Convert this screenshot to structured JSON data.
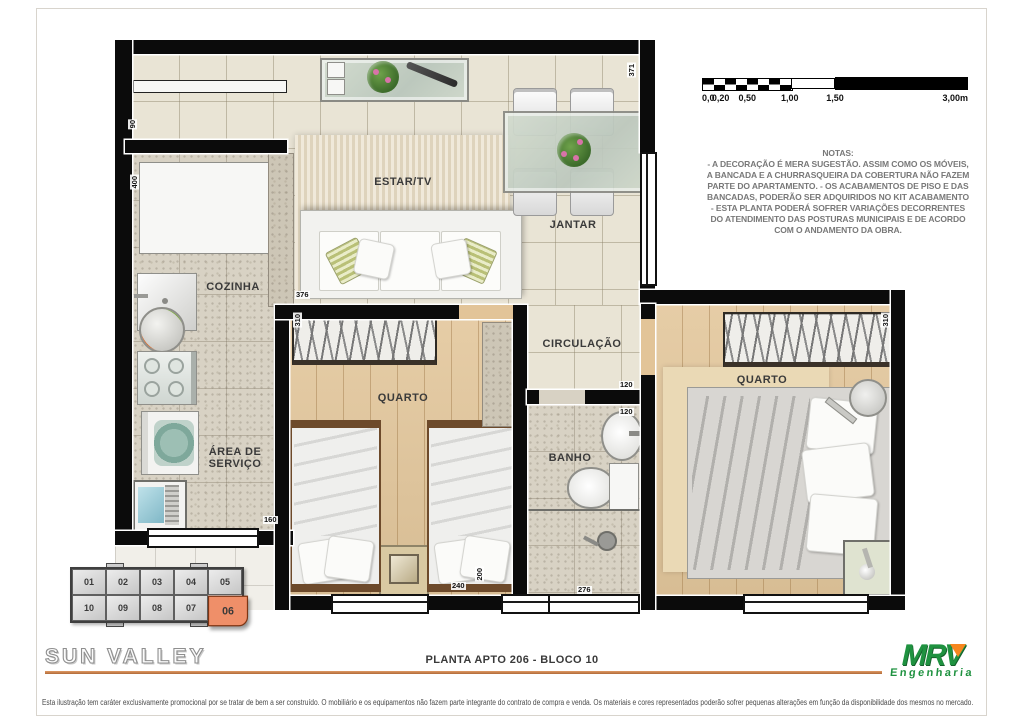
{
  "plan": {
    "rooms": {
      "estar": {
        "label": "ESTAR/TV"
      },
      "jantar": {
        "label": "JANTAR"
      },
      "cozinha": {
        "label": "COZINHA"
      },
      "area_servico": {
        "label": "ÁREA DE SERVIÇO"
      },
      "circulacao": {
        "label": "CIRCULAÇÃO"
      },
      "quarto1": {
        "label": "QUARTO"
      },
      "banho": {
        "label": "BANHO"
      },
      "quarto2": {
        "label": "QUARTO"
      }
    },
    "dims": {
      "d371": "371",
      "d90": "90",
      "d400": "400",
      "d376": "376",
      "d310a": "310",
      "d310b": "310",
      "d120a": "120",
      "d120b": "120",
      "d160": "160",
      "d240": "240",
      "d200": "200",
      "d276": "276"
    }
  },
  "scale_bar": {
    "labels": [
      {
        "text": "0,0",
        "pos": 0
      },
      {
        "text": "0,20",
        "pos": 7
      },
      {
        "text": "0,50",
        "pos": 17
      },
      {
        "text": "1,00",
        "pos": 33
      },
      {
        "text": "1,50",
        "pos": 50
      },
      {
        "text": "3,00m",
        "pos": 100
      }
    ]
  },
  "notes": {
    "title": "NOTAS:",
    "lines": [
      "- A DECORAÇÃO É MERA SUGESTÃO. ASSIM COMO OS MÓVEIS,",
      "A BANCADA E A CHURRASQUEIRA DA COBERTURA NÃO FAZEM",
      "PARTE DO APARTAMENTO. - OS ACABAMENTOS DE PISO E DAS",
      "BANCADAS, PODERÃO SER ADQUIRIDOS NO KIT ACABAMENTO",
      "-  ESTA PLANTA PODERÁ SOFRER VARIAÇÕES DECORRENTES",
      "DO ATENDIMENTO DAS POSTURAS  MUNICIPAIS E DE ACORDO",
      "COM O ANDAMENTO DA OBRA."
    ]
  },
  "unit_key": {
    "rows": [
      [
        "01",
        "02",
        "03",
        "04",
        "05"
      ],
      [
        "10",
        "09",
        "08",
        "07",
        "06"
      ]
    ],
    "highlighted": "06",
    "highlight_color": "#ef8f69"
  },
  "footer": {
    "project_name": "SUN VALLEY",
    "plan_title": "PLANTA  APTO 206 - BLOCO 10",
    "logo": {
      "brand": "MRV",
      "subtitle": "Engenharia",
      "green": "#1f9240",
      "orange": "#f6861f"
    },
    "disclaimer": "Esta ilustração tem caráter exclusivamente promocional por se tratar de bem a ser construído. O mobiliário e os equipamentos não fazem parte integrante do contrato de compra e venda. Os materiais e cores representados poderão sofrer pequenas alterações em função da disponibilidade dos mesmos no mercado."
  }
}
